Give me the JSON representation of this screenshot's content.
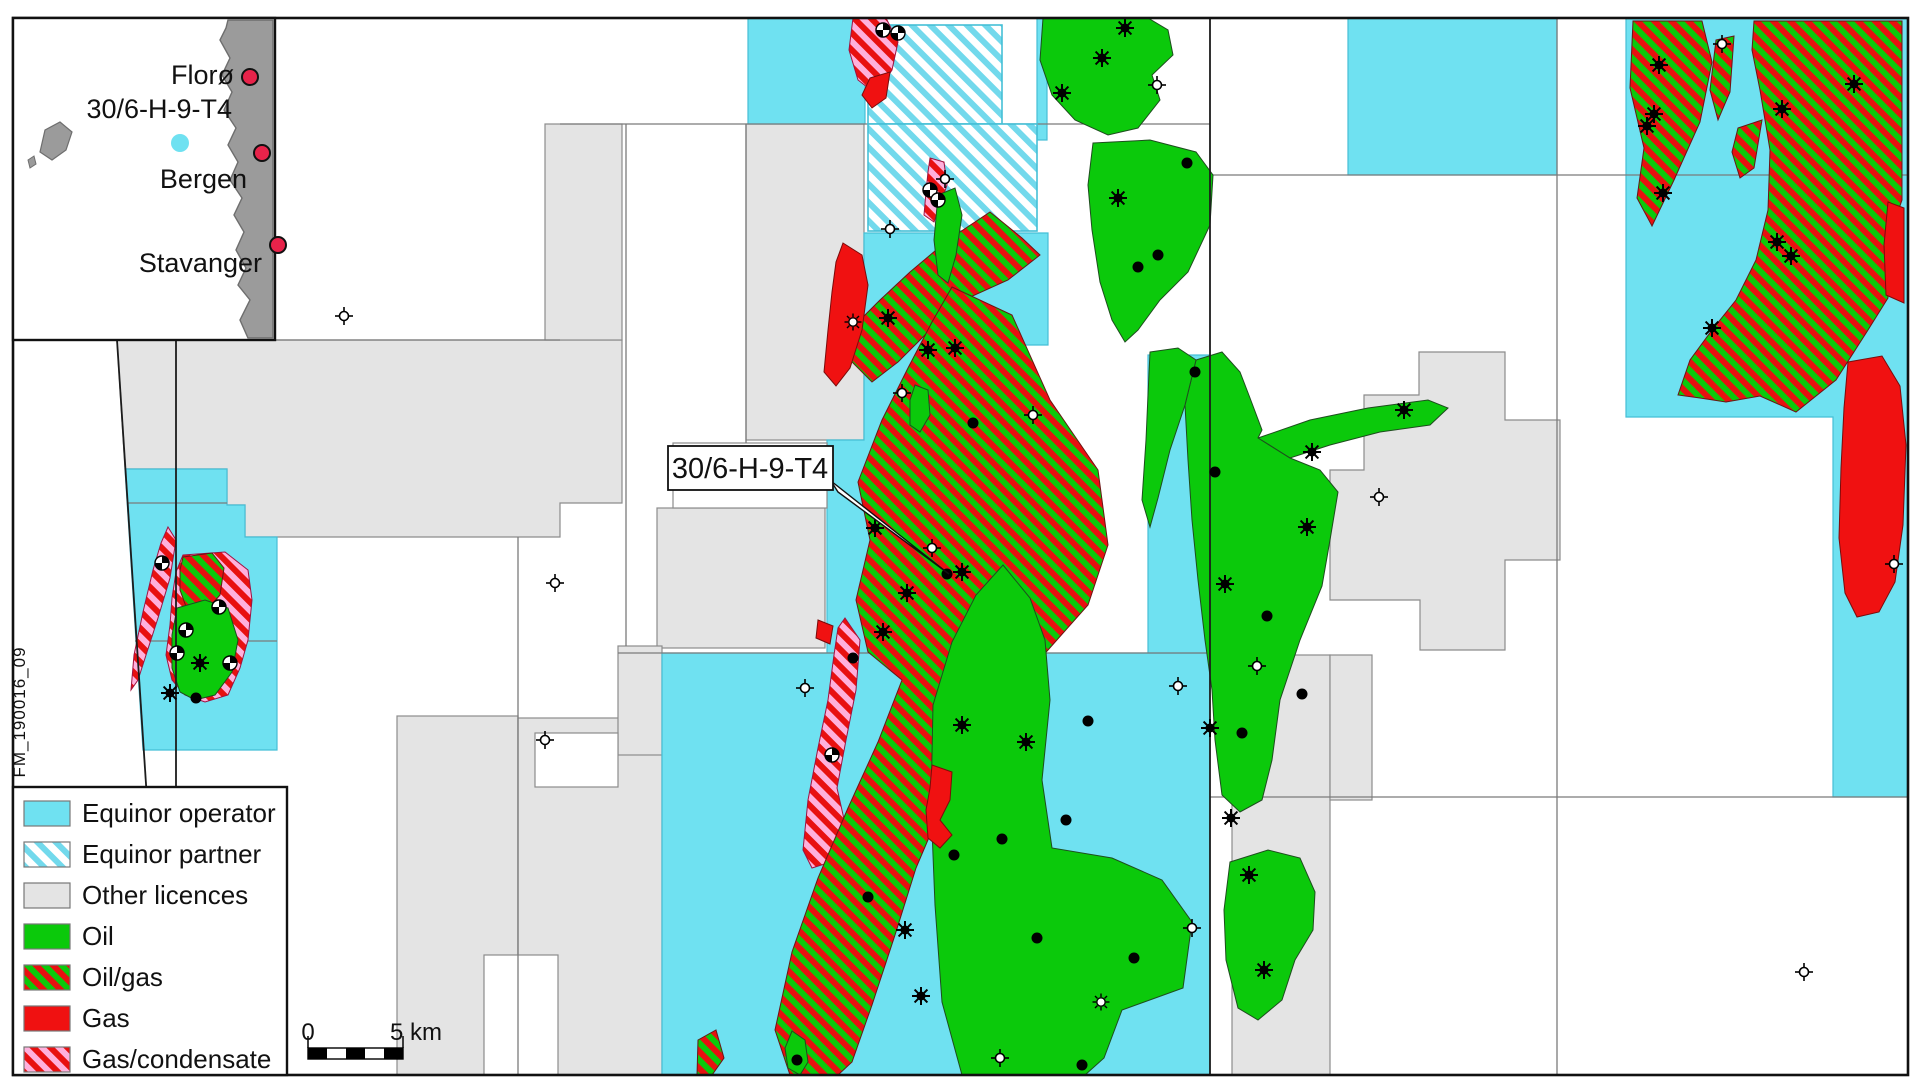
{
  "map": {
    "well_callout": "30/6-H-9-T4",
    "figure_id": "FM_190016_09"
  },
  "inset": {
    "cities": [
      {
        "name": "Florø"
      },
      {
        "name": "Bergen"
      },
      {
        "name": "Stavanger"
      }
    ],
    "well_label": "30/6-H-9-T4"
  },
  "legend": {
    "items": [
      {
        "id": "equinor-operator",
        "label": "Equinor operator",
        "swatch": "operator"
      },
      {
        "id": "equinor-partner",
        "label": "Equinor partner",
        "swatch": "partner"
      },
      {
        "id": "other-licences",
        "label": "Other licences",
        "swatch": "other"
      },
      {
        "id": "oil",
        "label": "Oil",
        "swatch": "oil"
      },
      {
        "id": "oil-gas",
        "label": "Oil/gas",
        "swatch": "oilgas"
      },
      {
        "id": "gas",
        "label": "Gas",
        "swatch": "gas"
      },
      {
        "id": "gas-condensate",
        "label": "Gas/condensate",
        "swatch": "gascond"
      }
    ]
  },
  "scalebar": {
    "start_label": "0",
    "end_label": "5 km"
  },
  "colors": {
    "equinor_operator": "#6FE1F1",
    "partner_stripe": "#72D9EC",
    "other_licences": "#E4E4E4",
    "oil_green": "#0BC90B",
    "gas_red": "#F01111",
    "gas_condensate_pink": "#FFB0DC",
    "stripe_red": "#E81010",
    "city_marker_red": "#E8234A",
    "inset_land_gray": "#9B9B9B"
  }
}
